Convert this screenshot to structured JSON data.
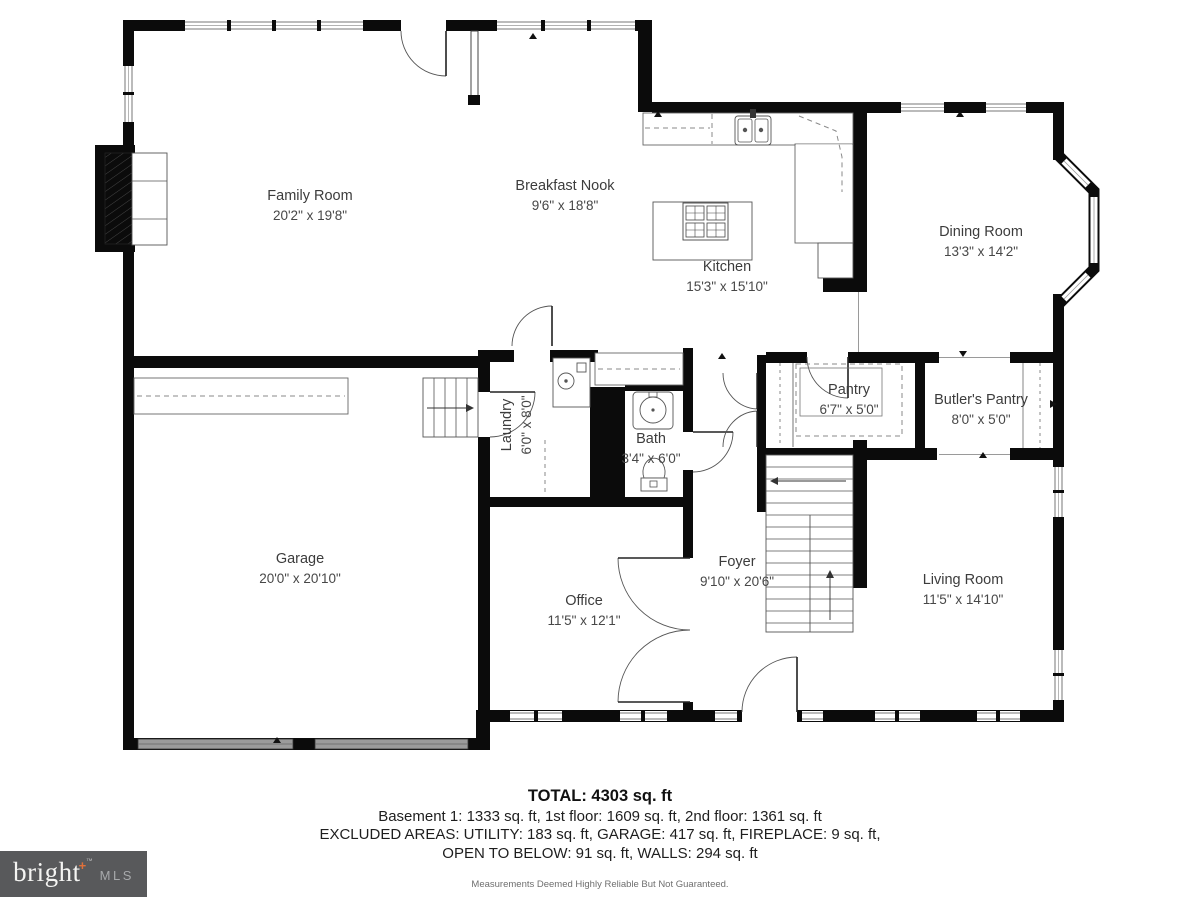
{
  "plan_title": "First floor plan",
  "rooms": [
    {
      "id": "family-room",
      "name": "Family Room",
      "dims": "20'2\" x 19'8\""
    },
    {
      "id": "breakfast-nook",
      "name": "Breakfast Nook",
      "dims": "9'6\" x 18'8\""
    },
    {
      "id": "kitchen",
      "name": "Kitchen",
      "dims": "15'3\" x 15'10\""
    },
    {
      "id": "dining-room",
      "name": "Dining Room",
      "dims": "13'3\" x 14'2\""
    },
    {
      "id": "laundry",
      "name": "Laundry",
      "dims": "6'0\" x 8'0\""
    },
    {
      "id": "bath",
      "name": "Bath",
      "dims": "3'4\" x 6'0\""
    },
    {
      "id": "pantry",
      "name": "Pantry",
      "dims": "6'7\" x 5'0\""
    },
    {
      "id": "butlers-pantry",
      "name": "Butler's Pantry",
      "dims": "8'0\" x 5'0\""
    },
    {
      "id": "garage",
      "name": "Garage",
      "dims": "20'0\" x 20'10\""
    },
    {
      "id": "office",
      "name": "Office",
      "dims": "11'5\" x 12'1\""
    },
    {
      "id": "foyer",
      "name": "Foyer",
      "dims": "9'10\" x 20'6\""
    },
    {
      "id": "living-room",
      "name": "Living Room",
      "dims": "11'5\" x 14'10\""
    }
  ],
  "summary": {
    "total": "TOTAL: 4303 sq. ft",
    "floors": "Basement 1: 1333 sq. ft, 1st floor: 1609 sq. ft, 2nd floor: 1361 sq. ft",
    "excluded_line1": "EXCLUDED AREAS: UTILITY: 183 sq. ft, GARAGE: 417 sq. ft, FIREPLACE: 9 sq. ft,",
    "excluded_line2": "OPEN TO BELOW: 91 sq. ft, WALLS: 294 sq. ft",
    "disclaimer": "Measurements Deemed Highly Reliable But Not Guaranteed."
  },
  "logo": {
    "brand": "bright",
    "plus": "+",
    "trademark": "™",
    "suffix": "MLS"
  },
  "icons": [
    "fireplace-icon",
    "cooktop-icon",
    "kitchen-sink-icon",
    "refrigerator-icon",
    "washer-icon",
    "bath-sink-icon",
    "toilet-icon",
    "stairs-icon",
    "basement-stairs-icon",
    "garage-stairs-icon",
    "garage-door-icon",
    "window-icon",
    "door-swing-icon",
    "shelf-icon",
    "pantry-shelves-icon",
    "butlers-cabinet-icon",
    "measure-tick-icon"
  ],
  "colors": {
    "wall": "#0b0b0b",
    "fixture_line": "#555555",
    "dashed_line": "#8a8a8a",
    "garage_door": "#9b9b9b",
    "label_text": "#3c3c3c",
    "logo_bg": "#58595b",
    "logo_text": "#f4f4f2",
    "logo_accent": "#e0703a",
    "logo_mls": "#a7a9ab"
  }
}
